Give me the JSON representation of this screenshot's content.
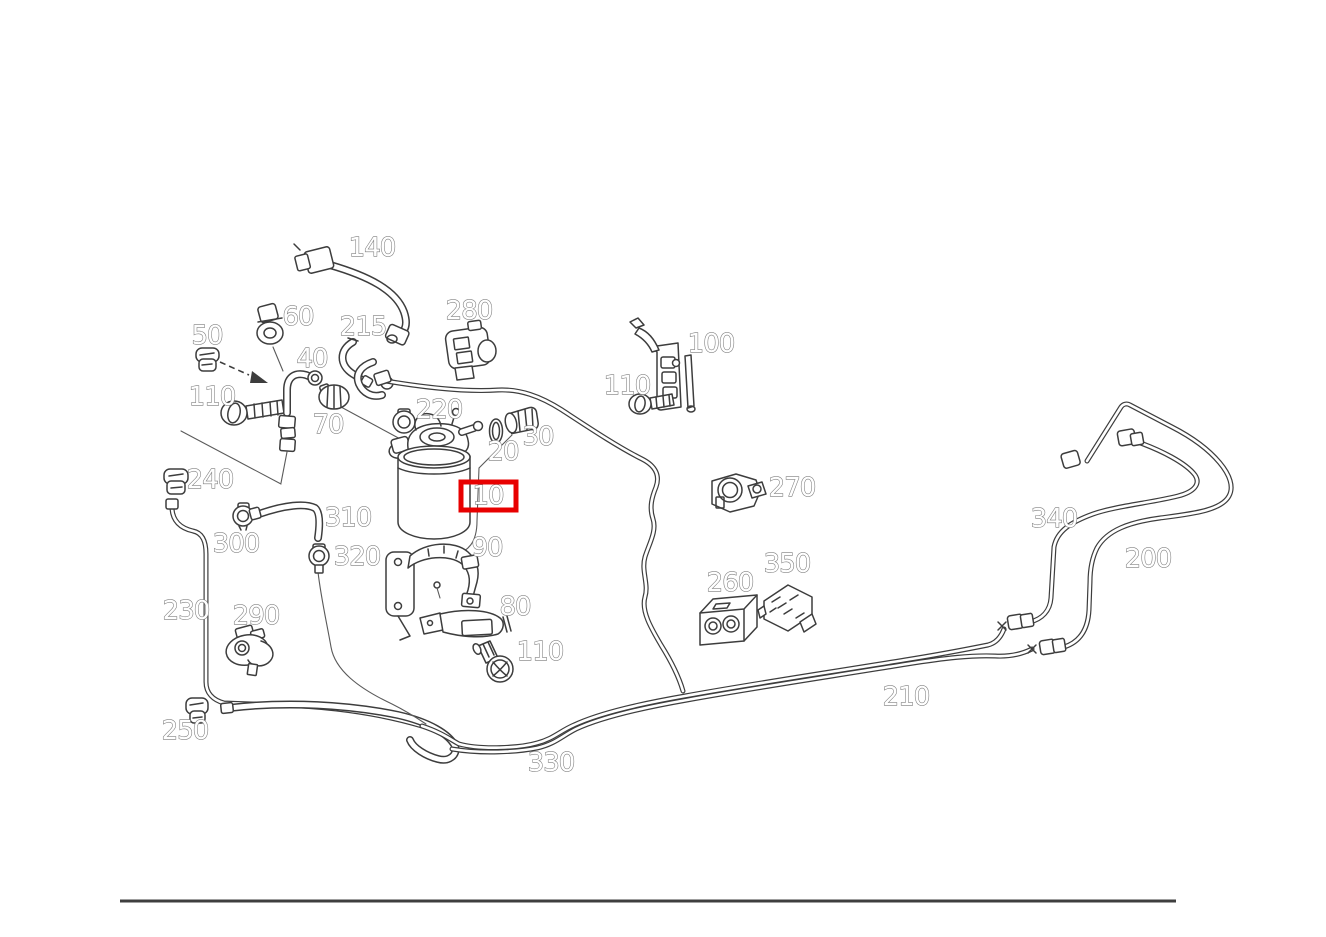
{
  "diagram": {
    "background_color": "#ffffff",
    "art_color": "#3d3d3d",
    "label_color": "#7d7d7d",
    "highlight": {
      "label": "10",
      "x": 461,
      "y": 482,
      "width": 55,
      "height": 28,
      "color": "#e80000",
      "border_width": 5
    },
    "footer_rule": {
      "x1": 120,
      "x2": 1176,
      "y": 901,
      "color": "#3f3f3f",
      "thickness": 3
    },
    "labels": [
      {
        "id": "140",
        "text": "140",
        "x": 372,
        "y": 248
      },
      {
        "id": "60",
        "text": "60",
        "x": 298,
        "y": 317
      },
      {
        "id": "215",
        "text": "215",
        "x": 363,
        "y": 327
      },
      {
        "id": "280",
        "text": "280",
        "x": 469,
        "y": 311
      },
      {
        "id": "50",
        "text": "50",
        "x": 207,
        "y": 336
      },
      {
        "id": "40",
        "text": "40",
        "x": 312,
        "y": 359
      },
      {
        "id": "100",
        "text": "100",
        "x": 711,
        "y": 344
      },
      {
        "id": "110-upper-right",
        "text": "110",
        "x": 627,
        "y": 386
      },
      {
        "id": "110-upper-left",
        "text": "110",
        "x": 212,
        "y": 397
      },
      {
        "id": "70",
        "text": "70",
        "x": 328,
        "y": 425
      },
      {
        "id": "220",
        "text": "220",
        "x": 439,
        "y": 410
      },
      {
        "id": "30",
        "text": "30",
        "x": 538,
        "y": 437
      },
      {
        "id": "20",
        "text": "20",
        "x": 503,
        "y": 452
      },
      {
        "id": "10",
        "text": "10",
        "x": 488,
        "y": 496
      },
      {
        "id": "270",
        "text": "270",
        "x": 792,
        "y": 488
      },
      {
        "id": "240",
        "text": "240",
        "x": 210,
        "y": 480
      },
      {
        "id": "310",
        "text": "310",
        "x": 348,
        "y": 518
      },
      {
        "id": "340",
        "text": "340",
        "x": 1054,
        "y": 519
      },
      {
        "id": "300",
        "text": "300",
        "x": 236,
        "y": 544
      },
      {
        "id": "90",
        "text": "90",
        "x": 487,
        "y": 548
      },
      {
        "id": "320",
        "text": "320",
        "x": 357,
        "y": 557
      },
      {
        "id": "200",
        "text": "200",
        "x": 1148,
        "y": 559
      },
      {
        "id": "350",
        "text": "350",
        "x": 787,
        "y": 564
      },
      {
        "id": "260",
        "text": "260",
        "x": 730,
        "y": 583
      },
      {
        "id": "230",
        "text": "230",
        "x": 186,
        "y": 611
      },
      {
        "id": "290",
        "text": "290",
        "x": 256,
        "y": 616
      },
      {
        "id": "80",
        "text": "80",
        "x": 515,
        "y": 607
      },
      {
        "id": "110-lower",
        "text": "110",
        "x": 540,
        "y": 652
      },
      {
        "id": "250",
        "text": "250",
        "x": 185,
        "y": 731
      },
      {
        "id": "210",
        "text": "210",
        "x": 906,
        "y": 697
      },
      {
        "id": "330",
        "text": "330",
        "x": 551,
        "y": 763
      }
    ]
  }
}
